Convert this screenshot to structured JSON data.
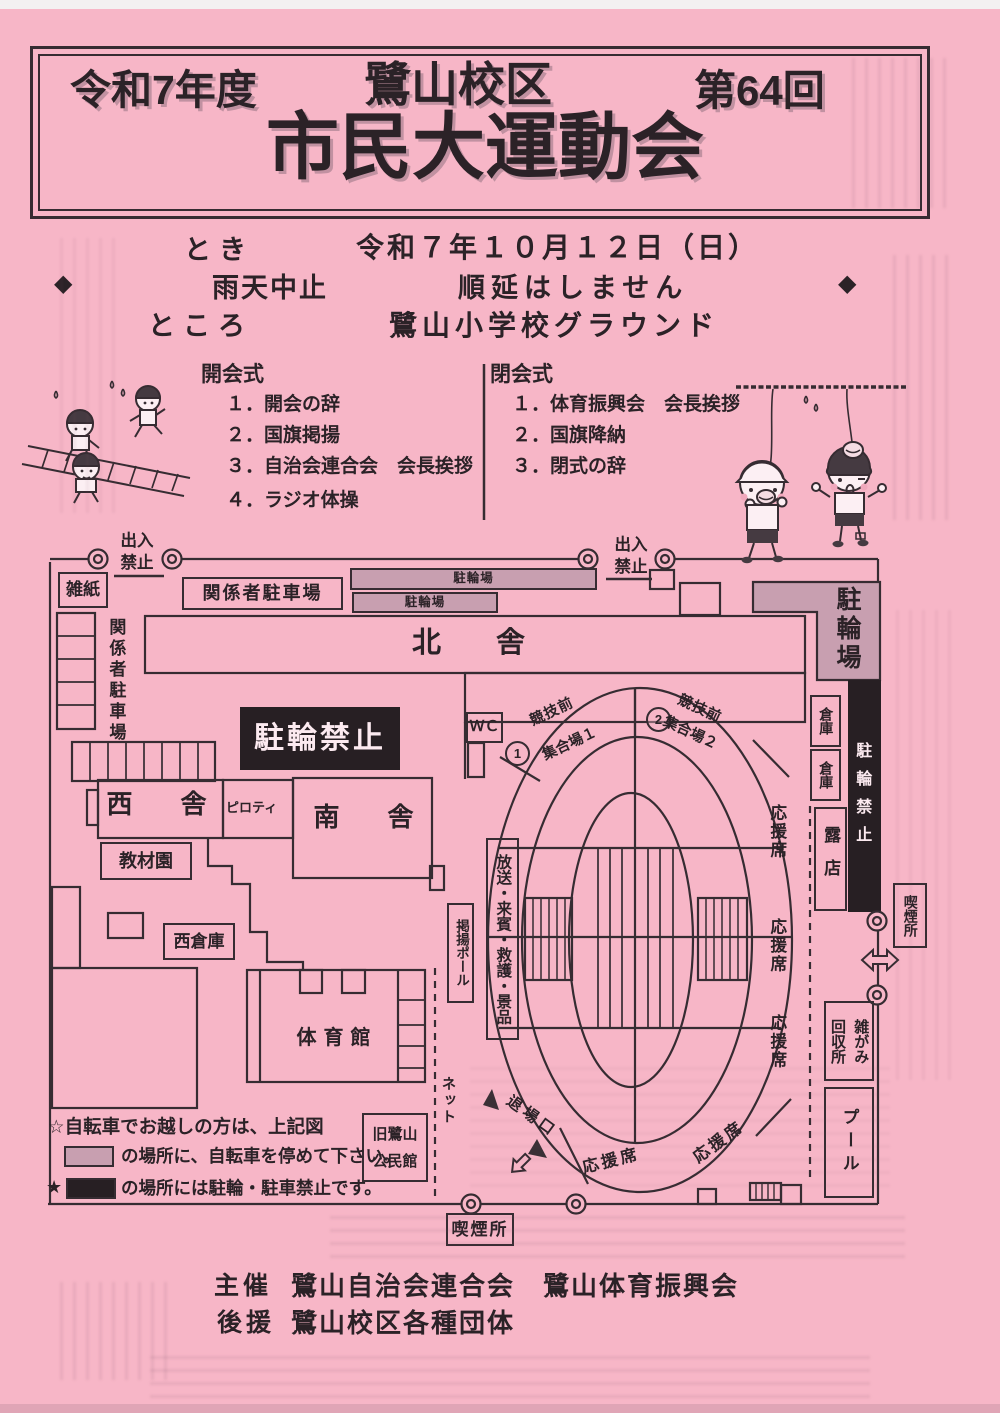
{
  "document": {
    "kind": "scanned event flyer"
  },
  "colors": {
    "paper": "#f7b6c7",
    "ink": "#362c32",
    "bike_area": "#c89fb0",
    "forbidden_black": "#271f23",
    "light_text": "#fceaf0"
  },
  "header": {
    "era": "令和7年度",
    "district": "鷺山校区",
    "round": "第64回",
    "title": "市民大運動会"
  },
  "info": {
    "diamond": "◆",
    "when_label": "とき",
    "when_value": "令和７年１０月１２日（日）",
    "rain_rule_1": "雨天中止",
    "rain_rule_2": "順延はしません",
    "where_label": "ところ",
    "where_value": "鷺山小学校グラウンド"
  },
  "ceremonies": {
    "opening": {
      "title": "開会式",
      "items": [
        "１．開会の辞",
        "２．国旗掲揚",
        "３．自治会連合会　会長挨拶",
        "４．ラジオ体操"
      ]
    },
    "closing": {
      "title": "閉会式",
      "items": [
        "１．体育振興会　会長挨拶",
        "２．国旗降納",
        "３．閉式の辞"
      ]
    }
  },
  "map": {
    "gate": "出入\n禁止",
    "waste_paper": "雑紙",
    "staff_parking": "関係者駐車場",
    "bike_parking": "駐輪場",
    "no_bike": "駐輪禁止",
    "north_building": "北　舎",
    "west_building": "西　舎",
    "south_building": "南　舎",
    "piloti": "ピロティ",
    "warehouse": "倉庫",
    "wc": "ＷＣ",
    "teaching_garden": "教材園",
    "west_warehouse": "西倉庫",
    "gym": "体育館",
    "num_1": "1",
    "num_2": "2",
    "pre_competition": "競技前",
    "assembly_1": "集合場１",
    "assembly_2": "集合場２",
    "broadcast": "放送・来賓・救護・景品",
    "flag_pole": "掲揚ポール",
    "net": "ネット",
    "old_hall": "旧鷺山\n公民館",
    "exit_gate": "退場口",
    "cheer_seat": "応援席",
    "stall": "露店",
    "smoking": "喫煙所",
    "waste_collection": "雑がみ\n回収所",
    "pool": "プール"
  },
  "legend": {
    "line1": "☆自転車でお越しの方は、上記図",
    "line2": "の場所に、自転車を停めて下さい。",
    "line3_star": "★",
    "line3": "の場所には駐輪・駐車禁止です。"
  },
  "footer": {
    "host_label": "主催",
    "host": "鷺山自治会連合会　鷺山体育振興会",
    "support_label": "後援",
    "support": "鷺山校区各種団体"
  }
}
